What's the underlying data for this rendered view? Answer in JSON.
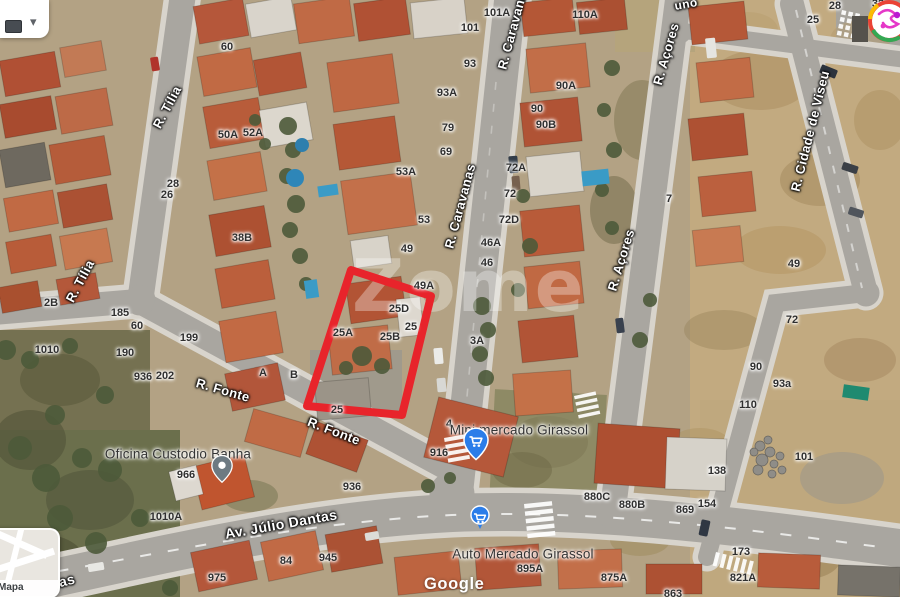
{
  "map": {
    "watermark": "Zome",
    "attribution_logo": "Google",
    "inset_label": "Mapa",
    "selection_outline_color": "#e8242b",
    "street_labels": [
      {
        "text": "R. Tília",
        "x": 167,
        "y": 107,
        "angle": -62,
        "size": 13
      },
      {
        "text": "R. Tília",
        "x": 80,
        "y": 281,
        "angle": -62,
        "size": 13
      },
      {
        "text": "R. Caravanas",
        "x": 513,
        "y": 27,
        "angle": -75,
        "size": 13
      },
      {
        "text": "R. Caravanas",
        "x": 460,
        "y": 206,
        "angle": -75,
        "size": 13
      },
      {
        "text": "R. Açores",
        "x": 666,
        "y": 54,
        "angle": -74,
        "size": 13
      },
      {
        "text": "R. Açores",
        "x": 621,
        "y": 260,
        "angle": -73,
        "size": 13
      },
      {
        "text": "R. Cidade de Viseu",
        "x": 810,
        "y": 131,
        "angle": -76,
        "size": 13
      },
      {
        "text": "R. Fonte",
        "x": 223,
        "y": 390,
        "angle": 16,
        "size": 13
      },
      {
        "text": "R. Fonte",
        "x": 334,
        "y": 431,
        "angle": 21,
        "size": 13
      },
      {
        "text": "Av. Júlio Dantas",
        "x": 281,
        "y": 524,
        "angle": -10,
        "size": 14
      },
      {
        "text": "ntas",
        "x": 60,
        "y": 582,
        "angle": -14,
        "size": 14
      },
      {
        "text": "uno",
        "x": 686,
        "y": 4,
        "angle": -10,
        "size": 12
      }
    ],
    "house_numbers": [
      {
        "text": "101A",
        "x": 497,
        "y": 13
      },
      {
        "text": "110A",
        "x": 585,
        "y": 15
      },
      {
        "text": "101",
        "x": 470,
        "y": 28
      },
      {
        "text": "60",
        "x": 227,
        "y": 47
      },
      {
        "text": "93",
        "x": 470,
        "y": 64
      },
      {
        "text": "90A",
        "x": 566,
        "y": 86
      },
      {
        "text": "93A",
        "x": 447,
        "y": 93
      },
      {
        "text": "90",
        "x": 537,
        "y": 109
      },
      {
        "text": "90B",
        "x": 546,
        "y": 125
      },
      {
        "text": "79",
        "x": 448,
        "y": 128
      },
      {
        "text": "50A",
        "x": 228,
        "y": 135
      },
      {
        "text": "52A",
        "x": 253,
        "y": 133
      },
      {
        "text": "69",
        "x": 446,
        "y": 152
      },
      {
        "text": "72A",
        "x": 516,
        "y": 168
      },
      {
        "text": "53A",
        "x": 406,
        "y": 172
      },
      {
        "text": "28",
        "x": 173,
        "y": 184
      },
      {
        "text": "72",
        "x": 510,
        "y": 194
      },
      {
        "text": "26",
        "x": 167,
        "y": 195
      },
      {
        "text": "7",
        "x": 669,
        "y": 199
      },
      {
        "text": "72D",
        "x": 509,
        "y": 220
      },
      {
        "text": "53",
        "x": 424,
        "y": 220
      },
      {
        "text": "38B",
        "x": 242,
        "y": 238
      },
      {
        "text": "46A",
        "x": 491,
        "y": 243
      },
      {
        "text": "49",
        "x": 407,
        "y": 249
      },
      {
        "text": "46",
        "x": 487,
        "y": 263
      },
      {
        "text": "49A",
        "x": 424,
        "y": 286
      },
      {
        "text": "25D",
        "x": 399,
        "y": 309
      },
      {
        "text": "25",
        "x": 411,
        "y": 327
      },
      {
        "text": "25A",
        "x": 343,
        "y": 333
      },
      {
        "text": "25B",
        "x": 390,
        "y": 337
      },
      {
        "text": "3A",
        "x": 477,
        "y": 341
      },
      {
        "text": "2B",
        "x": 51,
        "y": 303
      },
      {
        "text": "185",
        "x": 120,
        "y": 313
      },
      {
        "text": "60",
        "x": 137,
        "y": 326
      },
      {
        "text": "199",
        "x": 189,
        "y": 338
      },
      {
        "text": "1010",
        "x": 47,
        "y": 350
      },
      {
        "text": "190",
        "x": 125,
        "y": 353
      },
      {
        "text": "202",
        "x": 165,
        "y": 376
      },
      {
        "text": "936",
        "x": 143,
        "y": 377
      },
      {
        "text": "A",
        "x": 263,
        "y": 373
      },
      {
        "text": "B",
        "x": 294,
        "y": 375
      },
      {
        "text": "25",
        "x": 337,
        "y": 410
      },
      {
        "text": "4",
        "x": 449,
        "y": 424
      },
      {
        "text": "916",
        "x": 439,
        "y": 453
      },
      {
        "text": "966",
        "x": 186,
        "y": 475
      },
      {
        "text": "936",
        "x": 352,
        "y": 487
      },
      {
        "text": "1010A",
        "x": 166,
        "y": 517
      },
      {
        "text": "84",
        "x": 286,
        "y": 561
      },
      {
        "text": "945",
        "x": 328,
        "y": 558
      },
      {
        "text": "975",
        "x": 217,
        "y": 578
      },
      {
        "text": "895A",
        "x": 530,
        "y": 569
      },
      {
        "text": "875A",
        "x": 614,
        "y": 578
      },
      {
        "text": "863",
        "x": 673,
        "y": 594
      },
      {
        "text": "821A",
        "x": 743,
        "y": 578
      },
      {
        "text": "880C",
        "x": 597,
        "y": 497
      },
      {
        "text": "880B",
        "x": 632,
        "y": 505
      },
      {
        "text": "869",
        "x": 685,
        "y": 510
      },
      {
        "text": "138",
        "x": 717,
        "y": 471
      },
      {
        "text": "154",
        "x": 707,
        "y": 504
      },
      {
        "text": "173",
        "x": 741,
        "y": 552
      },
      {
        "text": "110",
        "x": 748,
        "y": 405
      },
      {
        "text": "93a",
        "x": 782,
        "y": 384
      },
      {
        "text": "90",
        "x": 756,
        "y": 367
      },
      {
        "text": "101",
        "x": 804,
        "y": 457
      },
      {
        "text": "49",
        "x": 794,
        "y": 264
      },
      {
        "text": "72",
        "x": 792,
        "y": 320
      },
      {
        "text": "25",
        "x": 813,
        "y": 20
      },
      {
        "text": "28",
        "x": 835,
        "y": 6
      },
      {
        "text": "32",
        "x": 878,
        "y": 4
      }
    ],
    "pois": [
      {
        "id": "oficina-custodio-banha",
        "name": "Oficina Custodio Banha",
        "icon": "map-pin",
        "color": "#6d7a82",
        "label_x": 178,
        "label_y": 454,
        "pin_x": 222,
        "pin_y": 489
      },
      {
        "id": "mini-mercado-girassol",
        "name": "Mini mercado Girassol",
        "icon": "shopping-cart-pin",
        "color": "#2b7de9",
        "label_x": 519,
        "label_y": 430,
        "pin_x": 476,
        "pin_y": 466
      },
      {
        "id": "auto-mercado-girassol",
        "name": "Auto Mercado Girassol",
        "icon": "shopping-cart-dot",
        "color": "#2b7de9",
        "label_x": 523,
        "label_y": 554,
        "pin_x": 480,
        "pin_y": 538
      }
    ]
  },
  "chrome": {
    "top_left_panel": {
      "dropdown_icon": "▾"
    },
    "avatar": {
      "icon": "account-avatar"
    }
  }
}
